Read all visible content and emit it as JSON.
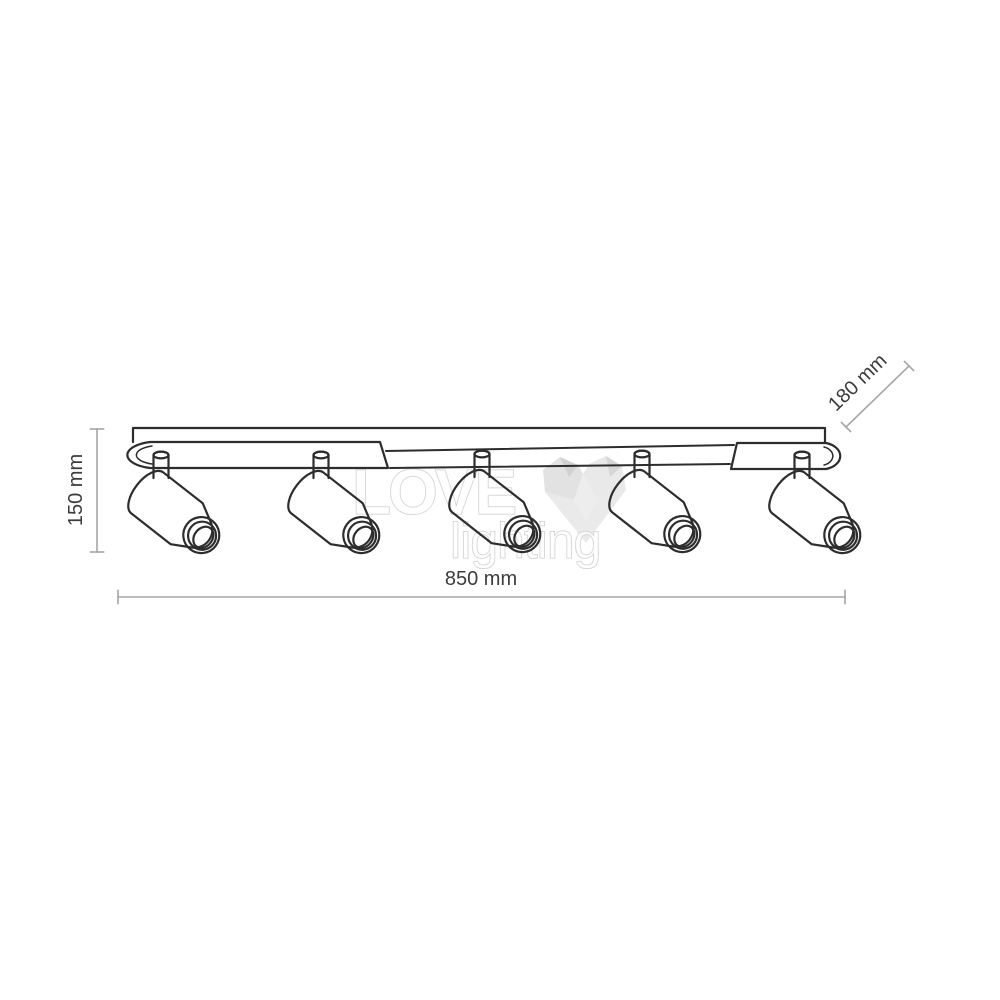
{
  "drawing": {
    "spotlight_count": 5,
    "dimensions": {
      "height": "150 mm",
      "length": "850 mm",
      "depth": "180 mm"
    },
    "watermark": {
      "word1": "LOVE",
      "word2": "lighting",
      "icon": "heart-icon"
    },
    "colors": {
      "background": "#ffffff",
      "outline": "#2d2d2d",
      "dimension_line": "#a5a5a5",
      "dimension_text": "#3c3c3c",
      "watermark_gray": "#c9c9c9"
    }
  }
}
